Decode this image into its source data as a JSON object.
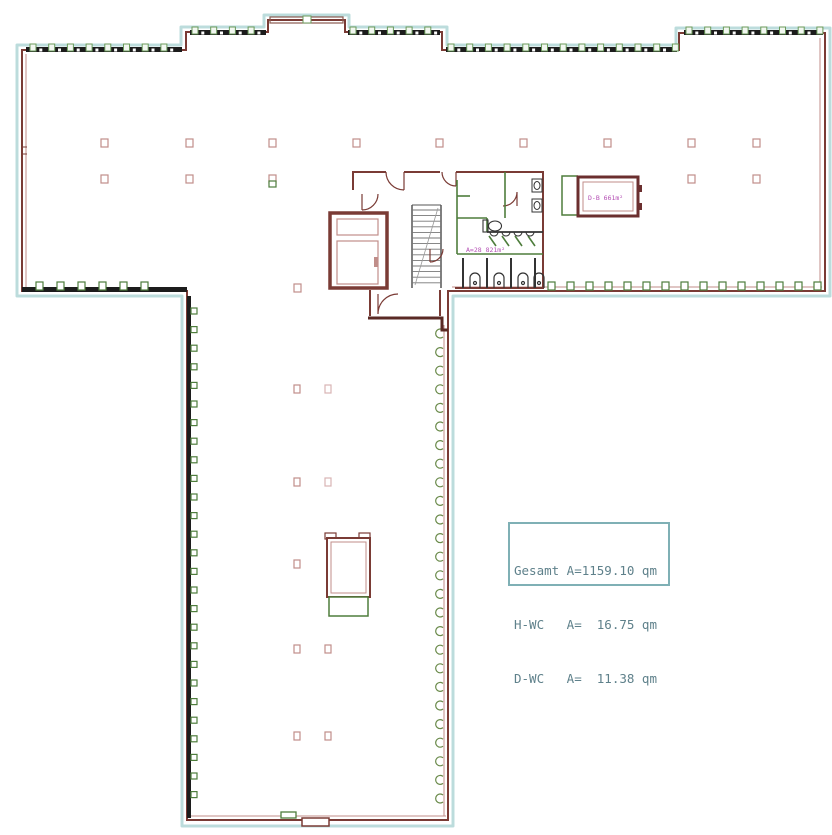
{
  "plan": {
    "title": "floor-plan",
    "area_box": {
      "rows": [
        "Gesamt A=1159.10 qm",
        "H-WC   A=  16.75 qm",
        "D-WC   A=  11.38 qm"
      ]
    },
    "room_label": "D-B 661m²",
    "wc_area_label": "A=28 821m²"
  },
  "colors": {
    "wall": "#7a3b35",
    "outer_offset": "#bcdcdc",
    "window_band": "#1c1c1c",
    "green": "#4e7d3c",
    "column": "#c08e8a",
    "magenta": "#b44fb4",
    "box_border": "#7fb0b5",
    "box_text": "#5f818b"
  }
}
